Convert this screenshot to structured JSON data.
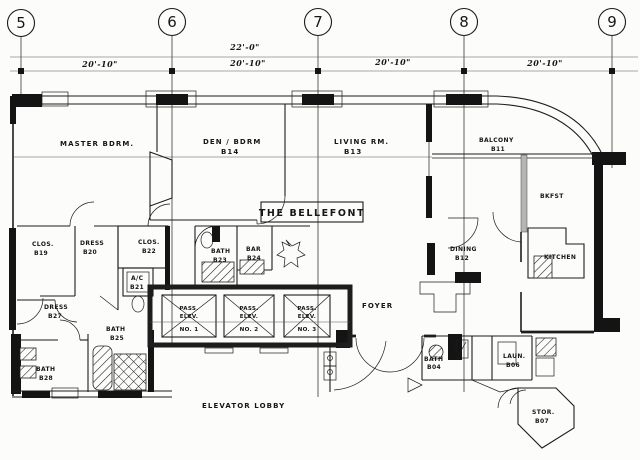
{
  "plan_title": "THE BELLEFONT",
  "columns": [
    "5",
    "6",
    "7",
    "8",
    "9"
  ],
  "dimensions": {
    "overall": "22'-0\"",
    "d56": "20'-10\"",
    "d67": "20'-10\"",
    "d78": "20'-10\"",
    "d89": "20'-10\""
  },
  "rooms": {
    "master": {
      "name": "MASTER  BDRM."
    },
    "den": {
      "name": "DEN / BDRM",
      "number": "B14"
    },
    "living": {
      "name": "LIVING  RM.",
      "number": "B13"
    },
    "balcony": {
      "name": "BALCONY",
      "number": "B11"
    },
    "bkfst": {
      "name": "BKFST"
    },
    "kitchen": {
      "name": "KITCHEN"
    },
    "dining": {
      "name": "DINING",
      "number": "B12"
    },
    "foyer": {
      "name": "FOYER"
    },
    "clos_b19": {
      "name": "CLOS.",
      "number": "B19"
    },
    "dress_b20": {
      "name": "DRESS",
      "number": "B20"
    },
    "clos_b22": {
      "name": "CLOS.",
      "number": "B22"
    },
    "ac_b21": {
      "name": "A/C",
      "number": "B21"
    },
    "bath_b23": {
      "name": "BATH",
      "number": "B23"
    },
    "bar_b24": {
      "name": "BAR",
      "number": "B24"
    },
    "dress_b27": {
      "name": "DRESS",
      "number": "B27"
    },
    "bath_b25": {
      "name": "BATH",
      "number": "B25"
    },
    "bath_b28": {
      "name": "BATH",
      "number": "B28"
    },
    "bath_b04": {
      "name": "BATH",
      "number": "B04"
    },
    "laun_b06": {
      "name": "LAUN.",
      "number": "B06"
    },
    "stor_b07": {
      "name": "STOR.",
      "number": "B07"
    },
    "elevator_lobby": {
      "name": "ELEVATOR  LOBBY"
    }
  },
  "elevators": [
    {
      "line1": "PASS.",
      "line2": "ELEV.",
      "line3": "NO. 1"
    },
    {
      "line1": "PASS.",
      "line2": "ELEV.",
      "line3": "NO. 2"
    },
    {
      "line1": "PASS.",
      "line2": "ELEV.",
      "line3": "NO. 3"
    }
  ],
  "ink_color": "#1d1d1d",
  "paper_color": "#fcfcfa"
}
